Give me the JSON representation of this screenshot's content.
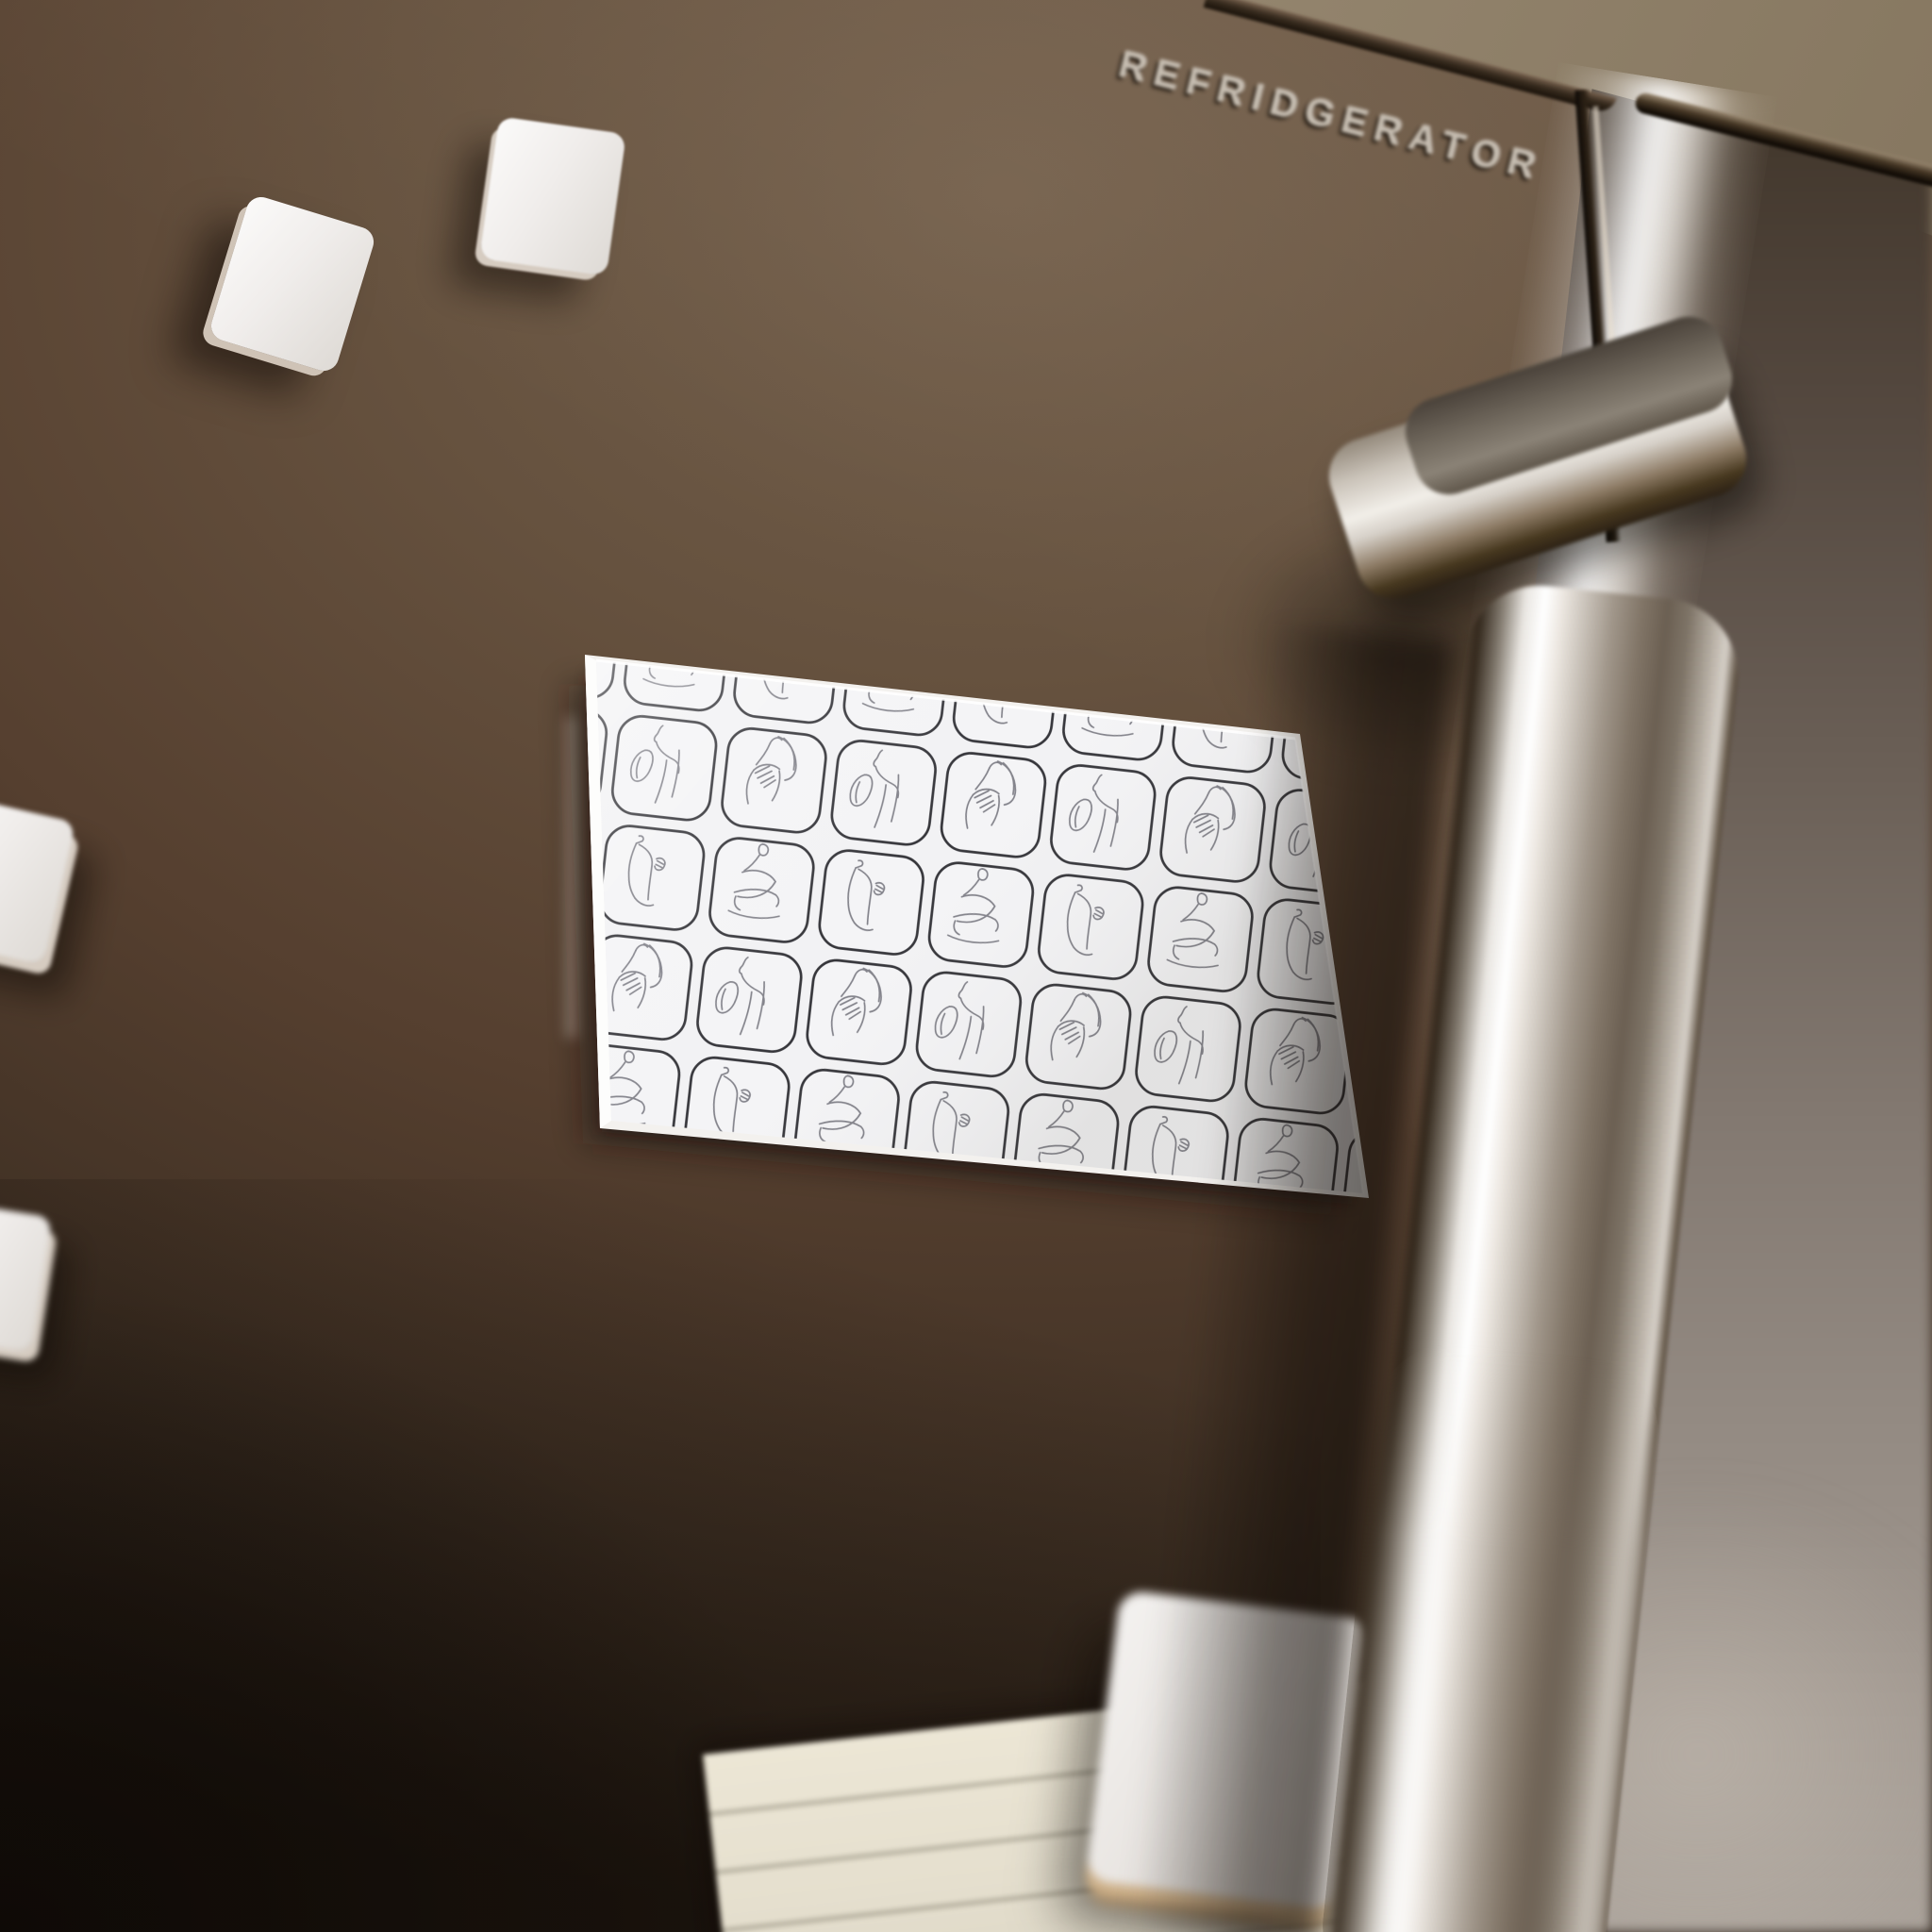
{
  "scene": {
    "type": "product-mockup-photo",
    "subject": "Rectangular fridge magnet with one-line female figure pattern on a dark brown refrigerator door",
    "brand_text": "REFRIDGERATOR"
  },
  "colors": {
    "door_brown": "#5a4737",
    "door_shadow": "#241b12",
    "wall_tan": "#968771",
    "steel_highlight": "#f5f3ef",
    "steel_mid": "#a1978b",
    "magnet_white": "#efecea",
    "magnet_side": "#cfc5b8",
    "pattern_background": "#f2f2f4",
    "pattern_frame": "#35353a",
    "pattern_figure": "#82828a",
    "note_paper": "#e8e2d1",
    "note_lines": "#a9a492"
  },
  "patterned_magnet": {
    "shape": "rounded rectangle",
    "tilt_deg": 6.4,
    "surface": "glossy white",
    "grid": {
      "visible_columns": 6,
      "visible_rows": 4,
      "tile_shape": "rounded-square"
    },
    "poses": [
      "profile-neck-and-shoulder",
      "long-hair-hand-on-chest",
      "back-view-standing",
      "seated-crossed-legs"
    ]
  },
  "blank_magnets": {
    "count": 5
  },
  "note_paper": {
    "ruled_lines": 3
  }
}
